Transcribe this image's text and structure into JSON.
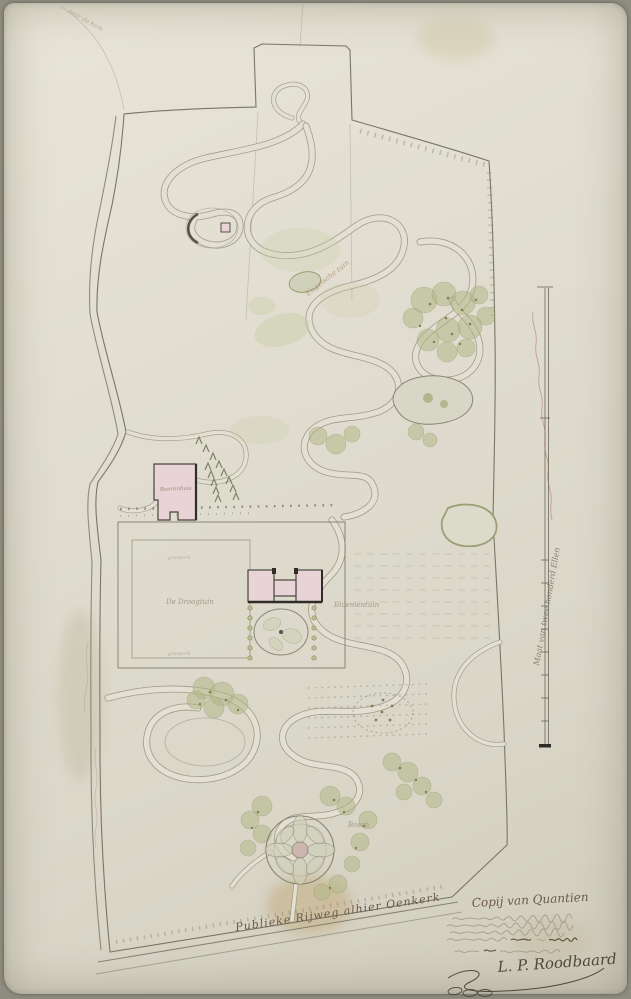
{
  "plan": {
    "region_labels": {
      "church_path": "naar de kerk",
      "english_garden": "Engelsche tuin",
      "farmhouse": "Boerenhuis",
      "drying_garden": "De Droogtuin",
      "grass_plot_top": "grasperk",
      "grass_plot_bottom": "grasperk",
      "flower_garden": "Bloementuin",
      "wood": "Bosch"
    },
    "road_label": "Publieke Rijweg alhier Oenkerk",
    "scale_label": "Maat van twee honderd Ellen",
    "title_block": {
      "heading": "Copij van Quantien",
      "handwriting_note": "vijf regels vervaagd handschrift",
      "signature": "L. P. Roodbaard"
    },
    "colors": {
      "paper": "#e0ddd0",
      "ink": "#7a7666",
      "dark_ink": "#4f483b",
      "vegetation": "#b3b887",
      "vegetation_dark": "#7c8258",
      "building_pink": "#e8d3d6",
      "red_ink": "#a3705f"
    }
  }
}
